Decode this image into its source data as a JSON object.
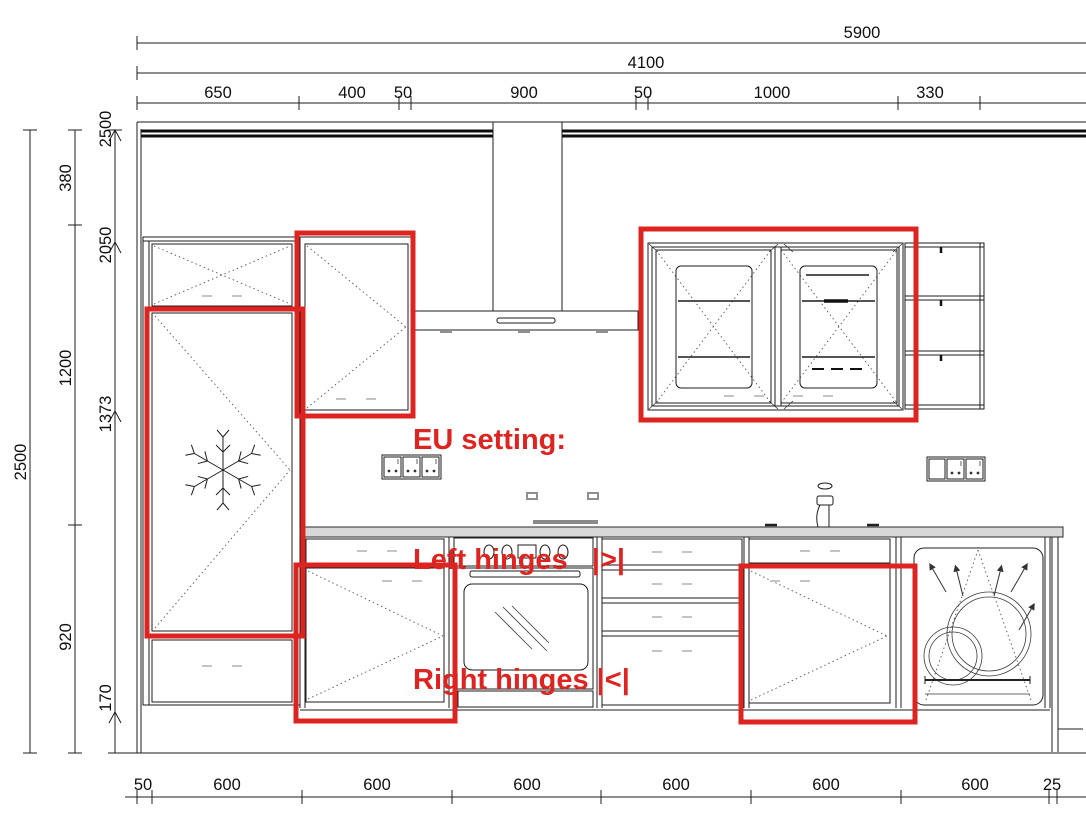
{
  "dimensions": {
    "top": {
      "total": "5900",
      "run": "4100",
      "segments": [
        "650",
        "400",
        "50",
        "900",
        "50",
        "1000",
        "330"
      ]
    },
    "left": {
      "total": "2500",
      "segments": [
        "380",
        "1200",
        "920"
      ],
      "levels": [
        "2500",
        "2050",
        "1373",
        "170"
      ]
    },
    "bottom": {
      "segments": [
        "50",
        "600",
        "600",
        "600",
        "600",
        "600",
        "600",
        "25"
      ]
    }
  },
  "annotation": {
    "line1": "EU setting:",
    "line2": "Left hinges   |>|",
    "line3": "Right hinges |<|"
  },
  "colors": {
    "highlight": "#de2420",
    "line": "#1c1c1c",
    "countertop": "#d8d8d8"
  }
}
